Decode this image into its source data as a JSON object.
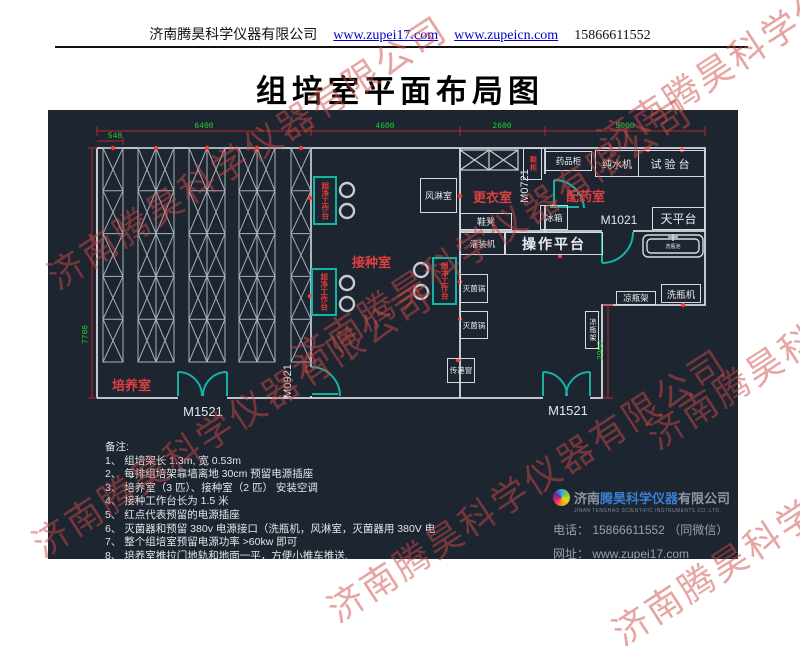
{
  "header": {
    "company": "济南腾昊科学仪器有限公司",
    "url1": "www.zupei17.com",
    "url2": "www.zupeicn.com",
    "phone": "15866611552"
  },
  "title": "组培室平面布局图",
  "watermark": {
    "text": "济南腾昊科学仪器有限公司"
  },
  "plan": {
    "dims": {
      "d548": "548",
      "d6400": "6400",
      "d4600": "4600",
      "d2600": "2600",
      "d5000": "5000",
      "d7700": "7700",
      "d2900": "2900"
    },
    "rooms": {
      "culture": "培养室",
      "inoculation": "接种室",
      "changing": "更衣室",
      "dispensing": "配药室"
    },
    "doors": {
      "m1521": "M1521",
      "m0921": "M0921",
      "m0721": "M0721",
      "m1021": "M1021"
    },
    "equipment": {
      "workbench": "超净工作台",
      "air_shower": "风淋室",
      "shoe_cabinet": "鞋柜",
      "medicine_cabinet": "药品柜",
      "water_machine": "纯水机",
      "test_bench": "试验台",
      "fridge": "冰箱",
      "shoe_bench": "鞋凳",
      "filling_machine": "灌装机",
      "operation_platform": "操作平台",
      "balance_table": "天平台",
      "sink": "洗瓶池",
      "sterilizer": "灭菌锅",
      "transfer_window": "传递窗",
      "bottle_rack": "凉瓶架",
      "bottle_washer": "洗瓶机"
    }
  },
  "notes": {
    "title": "备注:",
    "items": [
      "1、 组培架长 1.3m, 宽 0.53m",
      "2、 每排组培架靠墙离地 30cm 预留电源插座",
      "3、 培养室（3 匹）、接种室（2 匹） 安装空调",
      "4、 接种工作台长为 1.5 米",
      "5、 红点代表预留的电源插座",
      "6、 灭菌器和预留 380v 电源接口（洗瓶机，风淋室，灭菌器用 380V 电",
      "7、 整个组培室预留电源功率 >60kw 即可",
      "8、 培养室推拉门地轨和地面一平，方便小推车推送."
    ]
  },
  "footer": {
    "brand_prefix": "济南",
    "brand": "腾昊科学仪器",
    "brand_suffix": "有限公司",
    "en": "JINAN TENGHAO SCIENTIFIC INSTRUMENTS CO.,LTD.",
    "phone": "电话： 15866611552 （同微信）",
    "web": "网址： www.zupei17.com"
  }
}
